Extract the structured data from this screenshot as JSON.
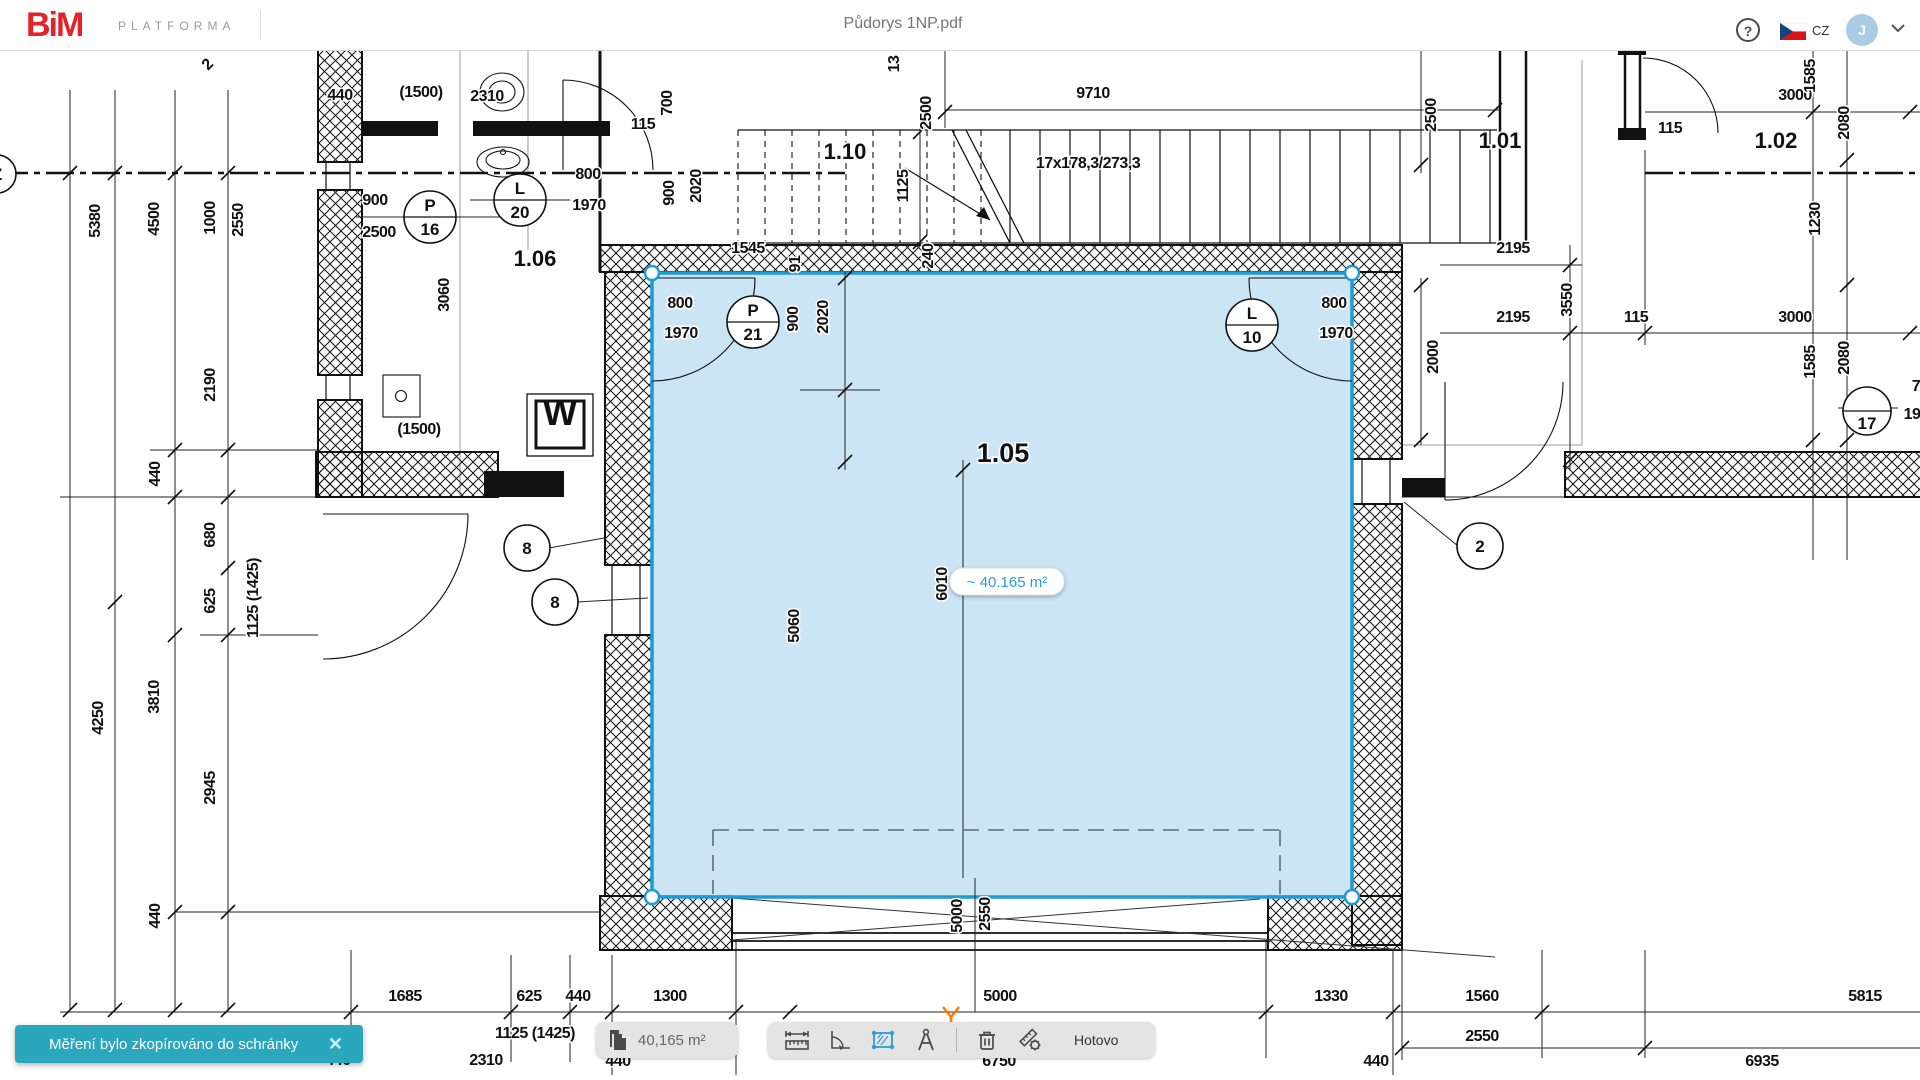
{
  "topbar": {
    "logo": "BiM",
    "logo_suffix": "PLATFORMA",
    "title": "Půdorys 1NP.pdf",
    "help_icon": "?",
    "language": "CZ",
    "avatar_initial": "J"
  },
  "toast": {
    "message": "Měření bylo zkopírováno do schránky",
    "close_icon": "✕"
  },
  "measure_toolbar": {
    "value": "40,165 m²",
    "done": "Hotovo"
  },
  "selection": {
    "tooltip": "~ 40.165 m²"
  },
  "colors": {
    "accent_blue": "#1E9AD6",
    "selection_fill": "#BADCF2",
    "toast_teal": "#2BA7BD",
    "logo_red": "#E2232A",
    "active_tool_blue": "#2E9BD6",
    "avatar_bg": "#A9CBE3",
    "marker_orange": "#FF7A00",
    "flag_red": "#D7141A",
    "flag_blue": "#11457E"
  },
  "plan": {
    "room_labels": [
      {
        "t": "1.06",
        "x": 535,
        "y": 266
      },
      {
        "t": "1.10",
        "x": 845,
        "y": 159
      },
      {
        "t": "1.05",
        "x": 1003,
        "y": 462,
        "big": true
      },
      {
        "t": "1.01",
        "x": 1500,
        "y": 148
      },
      {
        "t": "1.02",
        "x": 1776,
        "y": 148
      }
    ],
    "dim_labels": [
      {
        "t": "440",
        "x": 340,
        "y": 100
      },
      {
        "t": "(1500)",
        "x": 421,
        "y": 97
      },
      {
        "t": "2310",
        "x": 487,
        "y": 101
      },
      {
        "t": "115",
        "x": 643,
        "y": 129
      },
      {
        "t": "700",
        "x": 672,
        "y": 103,
        "r": -90
      },
      {
        "t": "900",
        "x": 375,
        "y": 205
      },
      {
        "t": "2500",
        "x": 379,
        "y": 237
      },
      {
        "t": "800",
        "x": 588,
        "y": 179
      },
      {
        "t": "1970",
        "x": 589,
        "y": 210
      },
      {
        "t": "900",
        "x": 674,
        "y": 193,
        "r": -90
      },
      {
        "t": "2020",
        "x": 701,
        "y": 186,
        "r": -90
      },
      {
        "t": "3060",
        "x": 449,
        "y": 295,
        "r": -90
      },
      {
        "t": "(1500)",
        "x": 419,
        "y": 434
      },
      {
        "t": "1545",
        "x": 748,
        "y": 253
      },
      {
        "t": "91",
        "x": 800,
        "y": 264,
        "r": -90
      },
      {
        "t": "13",
        "x": 899,
        "y": 64,
        "r": -90
      },
      {
        "t": "2500",
        "x": 931,
        "y": 113,
        "r": -90
      },
      {
        "t": "9710",
        "x": 1093,
        "y": 98
      },
      {
        "t": "1125",
        "x": 908,
        "y": 186,
        "r": -90
      },
      {
        "t": "17x178,3/273,3",
        "x": 1088,
        "y": 168
      },
      {
        "t": "240",
        "x": 933,
        "y": 256,
        "r": -90
      },
      {
        "t": "2500",
        "x": 1436,
        "y": 115,
        "r": -90
      },
      {
        "t": "3000",
        "x": 1795,
        "y": 100
      },
      {
        "t": "1585",
        "x": 1815,
        "y": 76,
        "r": -90
      },
      {
        "t": "2080",
        "x": 1849,
        "y": 123,
        "r": -90
      },
      {
        "t": "115",
        "x": 1670,
        "y": 133
      },
      {
        "t": "1230",
        "x": 1820,
        "y": 219,
        "r": -90
      },
      {
        "t": "2195",
        "x": 1513,
        "y": 253
      },
      {
        "t": "3550",
        "x": 1572,
        "y": 300,
        "r": -90
      },
      {
        "t": "2195",
        "x": 1513,
        "y": 322
      },
      {
        "t": "115",
        "x": 1636,
        "y": 322
      },
      {
        "t": "3000",
        "x": 1795,
        "y": 322
      },
      {
        "t": "2000",
        "x": 1438,
        "y": 357,
        "r": -90
      },
      {
        "t": "1585",
        "x": 1815,
        "y": 362,
        "r": -90
      },
      {
        "t": "2080",
        "x": 1849,
        "y": 358,
        "r": -90
      },
      {
        "t": "7",
        "x": 1916,
        "y": 391
      },
      {
        "t": "19",
        "x": 1912,
        "y": 419
      },
      {
        "t": "2",
        "x": 211,
        "y": 68,
        "r": -45
      },
      {
        "t": "5380",
        "x": 100,
        "y": 221,
        "r": -90
      },
      {
        "t": "4500",
        "x": 159,
        "y": 219,
        "r": -90
      },
      {
        "t": "1000",
        "x": 215,
        "y": 218,
        "r": -90
      },
      {
        "t": "2550",
        "x": 243,
        "y": 220,
        "r": -90
      },
      {
        "t": "2190",
        "x": 215,
        "y": 385,
        "r": -90
      },
      {
        "t": "440",
        "x": 160,
        "y": 474,
        "r": -90
      },
      {
        "t": "680",
        "x": 215,
        "y": 535,
        "r": -90
      },
      {
        "t": "625",
        "x": 215,
        "y": 601,
        "r": -90
      },
      {
        "t": "1125 (1425)",
        "x": 258,
        "y": 598,
        "r": -90
      },
      {
        "t": "4250",
        "x": 103,
        "y": 718,
        "r": -90
      },
      {
        "t": "3810",
        "x": 159,
        "y": 697,
        "r": -90
      },
      {
        "t": "2945",
        "x": 215,
        "y": 788,
        "r": -90
      },
      {
        "t": "440",
        "x": 160,
        "y": 916,
        "r": -90
      },
      {
        "t": "800",
        "x": 680,
        "y": 308
      },
      {
        "t": "1970",
        "x": 681,
        "y": 338
      },
      {
        "t": "900",
        "x": 798,
        "y": 319,
        "r": -90
      },
      {
        "t": "2020",
        "x": 828,
        "y": 317,
        "r": -90
      },
      {
        "t": "800",
        "x": 1334,
        "y": 308
      },
      {
        "t": "1970",
        "x": 1336,
        "y": 338
      },
      {
        "t": "5060",
        "x": 799,
        "y": 626,
        "r": -90
      },
      {
        "t": "6010",
        "x": 947,
        "y": 584,
        "r": -90
      },
      {
        "t": "5000",
        "x": 962,
        "y": 916,
        "r": -90
      },
      {
        "t": "2550",
        "x": 990,
        "y": 914,
        "r": -90
      },
      {
        "t": "1685",
        "x": 405,
        "y": 1001
      },
      {
        "t": "625",
        "x": 529,
        "y": 1001
      },
      {
        "t": "440",
        "x": 578,
        "y": 1001
      },
      {
        "t": "1300",
        "x": 670,
        "y": 1001
      },
      {
        "t": "5000",
        "x": 1000,
        "y": 1001
      },
      {
        "t": "1330",
        "x": 1331,
        "y": 1001
      },
      {
        "t": "1560",
        "x": 1482,
        "y": 1001
      },
      {
        "t": "5815",
        "x": 1865,
        "y": 1001
      },
      {
        "t": "1125 (1425)",
        "x": 535,
        "y": 1038
      },
      {
        "t": "2310",
        "x": 486,
        "y": 1065
      },
      {
        "t": "440",
        "x": 338,
        "y": 1065
      },
      {
        "t": "440",
        "x": 618,
        "y": 1066
      },
      {
        "t": "6750",
        "x": 999,
        "y": 1066
      },
      {
        "t": "2550",
        "x": 1482,
        "y": 1041
      },
      {
        "t": "440",
        "x": 1376,
        "y": 1066
      },
      {
        "t": "6935",
        "x": 1762,
        "y": 1066
      }
    ],
    "circles": [
      {
        "top": "P",
        "bot": "16",
        "x": 430,
        "y": 217,
        "r": 26,
        "split": true
      },
      {
        "top": "L",
        "bot": "20",
        "x": 520,
        "y": 200,
        "r": 26,
        "split": true
      },
      {
        "top": "P",
        "bot": "21",
        "x": 753,
        "y": 322,
        "r": 26,
        "split": true
      },
      {
        "top": "L",
        "bot": "10",
        "x": 1252,
        "y": 325,
        "r": 26,
        "split": true
      },
      {
        "bot": "8",
        "x": 527,
        "y": 548,
        "r": 23,
        "split": false
      },
      {
        "bot": "8",
        "x": 555,
        "y": 602,
        "r": 23,
        "split": false
      },
      {
        "bot": "2",
        "x": 1480,
        "y": 546,
        "r": 23,
        "split": false
      },
      {
        "top": "",
        "bot": "17",
        "x": 1867,
        "y": 411,
        "r": 24,
        "split": true
      },
      {
        "top": "Z",
        "x": -3,
        "y": 174,
        "r": 19,
        "split": false
      }
    ],
    "symbols": [
      {
        "t": "W",
        "x": 560,
        "y": 425
      }
    ]
  }
}
